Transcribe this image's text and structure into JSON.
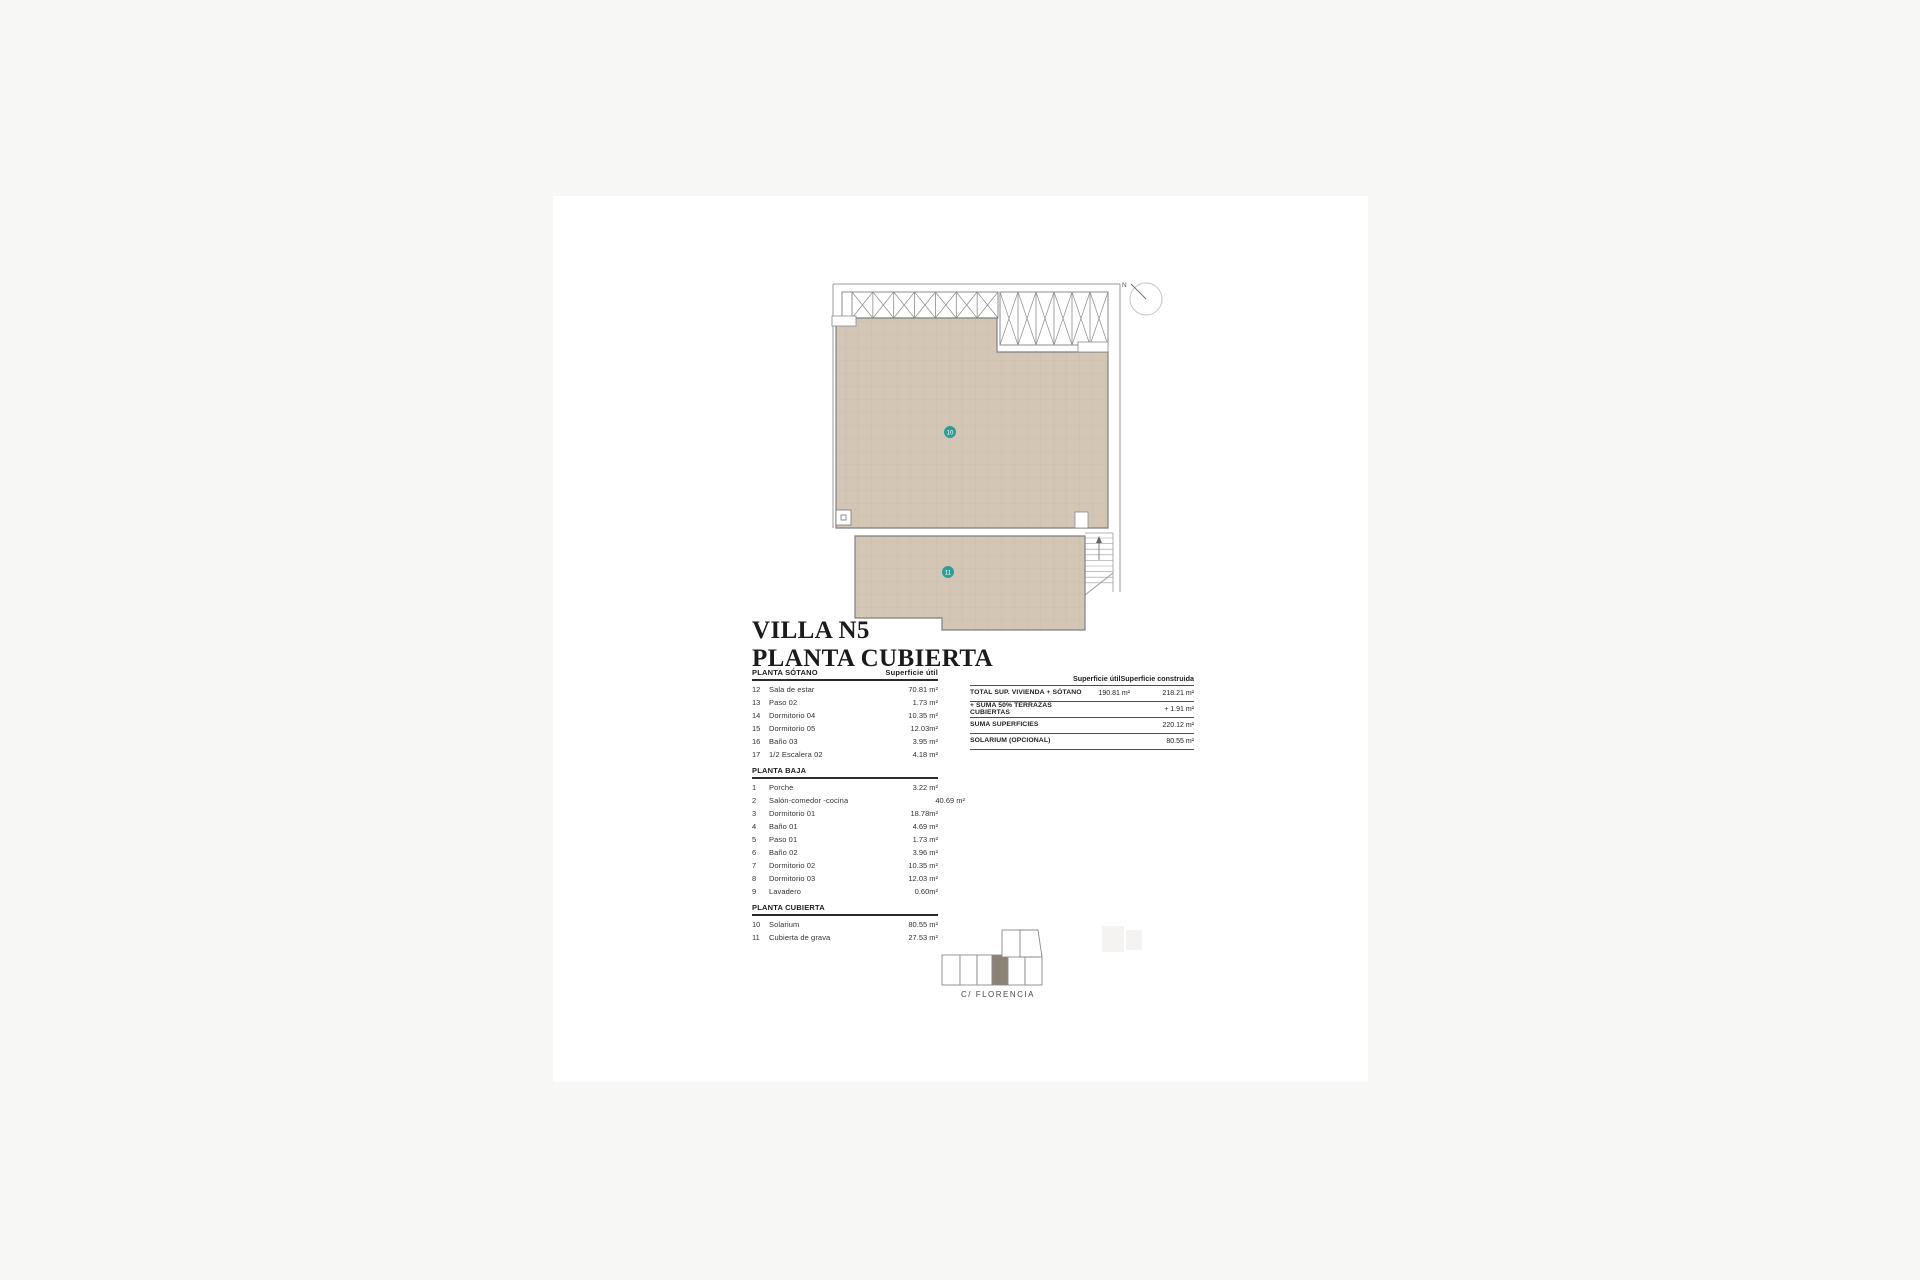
{
  "page": {
    "title_line1": "VILLA N5",
    "title_line2": "PLANTA CUBIERTA"
  },
  "plan": {
    "north_label": "N",
    "marker_10": "10",
    "marker_11": "11"
  },
  "areas_table": {
    "col_header": "Superficie útil",
    "sections": [
      {
        "name": "PLANTA SÓTANO",
        "rows": [
          {
            "num": "12",
            "name": "Sala de estar",
            "value": "70.81 m²"
          },
          {
            "num": "13",
            "name": "Paso 02",
            "value": "1.73 m²"
          },
          {
            "num": "14",
            "name": "Dormitorio 04",
            "value": "10.35 m²"
          },
          {
            "num": "15",
            "name": "Dormitorio 05",
            "value": "12.03m²"
          },
          {
            "num": "16",
            "name": "Baño 03",
            "value": "3.95 m²"
          },
          {
            "num": "17",
            "name": "1/2 Escalera 02",
            "value": "4.18 m²"
          }
        ]
      },
      {
        "name": "PLANTA BAJA",
        "rows": [
          {
            "num": "1",
            "name": "Porche",
            "value": "3.22 m²"
          },
          {
            "num": "2",
            "name": "Salón-comedor -cocina",
            "value": "40.69 m²",
            "offset": true
          },
          {
            "num": "3",
            "name": "Dormitorio 01",
            "value": "18.78m²"
          },
          {
            "num": "4",
            "name": "Baño 01",
            "value": "4.69 m²"
          },
          {
            "num": "5",
            "name": "Paso 01",
            "value": "1.73 m²"
          },
          {
            "num": "6",
            "name": "Baño 02",
            "value": "3.96 m²"
          },
          {
            "num": "7",
            "name": "Dormitorio 02",
            "value": "10.35 m²"
          },
          {
            "num": "8",
            "name": "Dormitorio 03",
            "value": "12.03 m²"
          },
          {
            "num": "9",
            "name": "Lavadero",
            "value": "0.60m²"
          }
        ]
      },
      {
        "name": "PLANTA CUBIERTA",
        "rows": [
          {
            "num": "10",
            "name": "Solarium",
            "value": "80.55 m²"
          },
          {
            "num": "11",
            "name": "Cubierta de grava",
            "value": "27.53 m²"
          }
        ]
      }
    ]
  },
  "summary_table": {
    "col1_header": "Superficie útil",
    "col2_header": "Superficie construida",
    "rows": [
      {
        "label": "TOTAL SUP. VIVIENDA + SÓTANO",
        "util": "190.81 m²",
        "construida": "218.21 m²"
      },
      {
        "label": "+ SUMA 50% TERRAZAS CUBIERTAS",
        "util": "",
        "construida": "+ 1.91 m²"
      },
      {
        "label": "SUMA SUPERFICIES",
        "util": "",
        "construida": "220.12 m²"
      },
      {
        "label": "SOLARIUM (OPCIONAL)",
        "util": "",
        "construida": "80.55 m²"
      }
    ]
  },
  "site": {
    "street_label": "C/ FLORENCIA"
  },
  "colors": {
    "roof_fill": "#d3c6b4",
    "roof_grid": "#c9bcab",
    "marker_teal": "#2f9e99",
    "site_plot_fill": "#8a8177",
    "plan_line": "#8c8c8c"
  }
}
